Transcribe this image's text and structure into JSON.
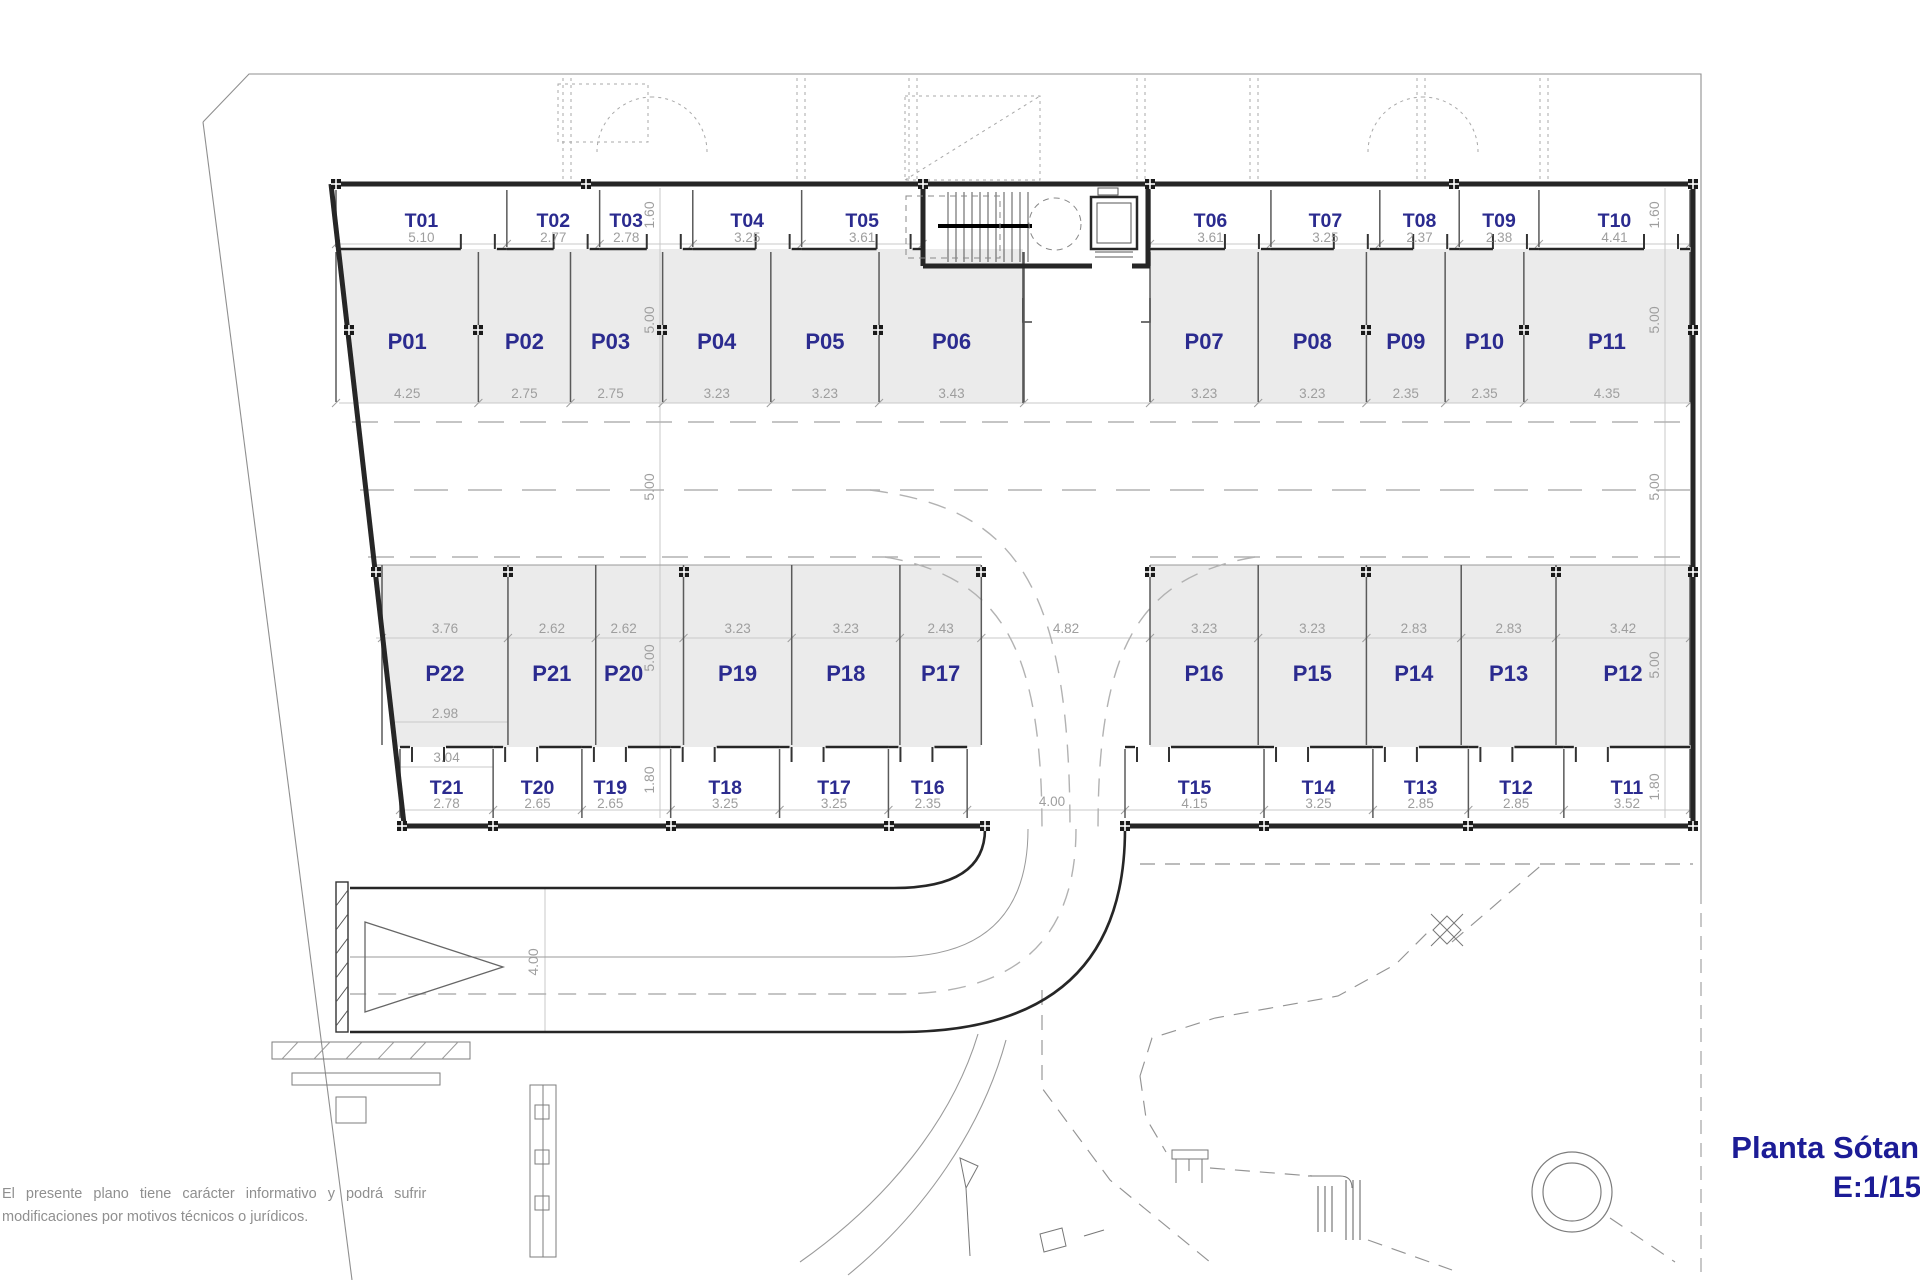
{
  "title": {
    "name": "Planta Sótano",
    "scale": "E:1/150"
  },
  "disclaimer": {
    "line1": "El presente plano tiene carácter informativo y podrá sufrir",
    "line2": "modificaciones por motivos técnicos o jurídicos."
  },
  "colors": {
    "unit_label": "#2b2b8f",
    "dimension_text": "#9e9e9e",
    "wall": "#262626",
    "stall_fill": "#ebebeb",
    "title_text": "#1c1c96"
  },
  "rows": {
    "upper_storage_left": {
      "units": [
        {
          "id": "T01",
          "width": "5.10"
        },
        {
          "id": "T02",
          "width": "2.77"
        },
        {
          "id": "T03",
          "width": "2.78"
        },
        {
          "id": "T04",
          "width": "3.25"
        },
        {
          "id": "T05",
          "width": "3.61"
        }
      ]
    },
    "upper_storage_right": {
      "units": [
        {
          "id": "T06",
          "width": "3.61"
        },
        {
          "id": "T07",
          "width": "3.25"
        },
        {
          "id": "T08",
          "width": "2.37"
        },
        {
          "id": "T09",
          "width": "2.38"
        },
        {
          "id": "T10",
          "width": "4.41"
        }
      ]
    },
    "upper_parking_left": {
      "units": [
        {
          "id": "P01",
          "width": "4.25"
        },
        {
          "id": "P02",
          "width": "2.75"
        },
        {
          "id": "P03",
          "width": "2.75"
        },
        {
          "id": "P04",
          "width": "3.23"
        },
        {
          "id": "P05",
          "width": "3.23"
        },
        {
          "id": "P06",
          "width": "3.43"
        }
      ]
    },
    "upper_parking_right": {
      "units": [
        {
          "id": "P07",
          "width": "3.23"
        },
        {
          "id": "P08",
          "width": "3.23"
        },
        {
          "id": "P09",
          "width": "2.35"
        },
        {
          "id": "P10",
          "width": "2.35"
        },
        {
          "id": "P11",
          "width": "4.35"
        }
      ]
    },
    "lower_parking_left": {
      "units": [
        {
          "id": "P22",
          "width": "3.76",
          "width2": "2.98"
        },
        {
          "id": "P21",
          "width": "2.62"
        },
        {
          "id": "P20",
          "width": "2.62"
        },
        {
          "id": "P19",
          "width": "3.23"
        },
        {
          "id": "P18",
          "width": "3.23"
        },
        {
          "id": "P17",
          "width": "2.43"
        }
      ]
    },
    "lower_parking_right": {
      "units": [
        {
          "id": "P16",
          "width": "3.23"
        },
        {
          "id": "P15",
          "width": "3.23"
        },
        {
          "id": "P14",
          "width": "2.83"
        },
        {
          "id": "P13",
          "width": "2.83"
        },
        {
          "id": "P12",
          "width": "3.42"
        }
      ]
    },
    "lower_storage_left": {
      "units": [
        {
          "id": "T21",
          "width": "2.78",
          "width2": "3.04"
        },
        {
          "id": "T20",
          "width": "2.65"
        },
        {
          "id": "T19",
          "width": "2.65"
        },
        {
          "id": "T18",
          "width": "3.25"
        },
        {
          "id": "T17",
          "width": "3.25"
        },
        {
          "id": "T16",
          "width": "2.35"
        }
      ]
    },
    "lower_storage_right": {
      "units": [
        {
          "id": "T15",
          "width": "4.15"
        },
        {
          "id": "T14",
          "width": "3.25"
        },
        {
          "id": "T13",
          "width": "2.85"
        },
        {
          "id": "T12",
          "width": "2.85"
        },
        {
          "id": "T11",
          "width": "3.52"
        }
      ]
    }
  },
  "depth_dimensions": {
    "left": [
      "1.60",
      "5.00",
      "5.00",
      "5.00",
      "1.80"
    ],
    "right": [
      "1.60",
      "5.00",
      "5.00",
      "5.00",
      "1.80"
    ]
  },
  "aisle_dimensions": {
    "parking_bay_opening": "4.82",
    "storage_row_opening": "4.00",
    "ramp_lane_width": "4.00"
  }
}
